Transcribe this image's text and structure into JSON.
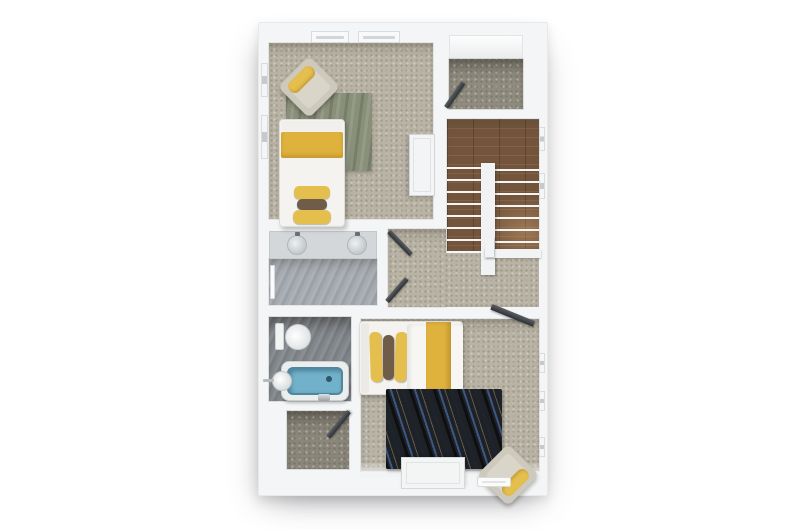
{
  "scene": {
    "type": "3d-floor-plan-render",
    "view": "top-down dollhouse",
    "background": "#ffffff",
    "floor_label": "upper floor"
  },
  "colors": {
    "wall": "#f4f5f6",
    "carpet": "#b8b3a4",
    "carpet_dark": "#8f8c7f",
    "carpet_dark2": "#8a867a",
    "wood": "#74553b",
    "tile_light": "#a6abb1",
    "tile_dark": "#82878c",
    "vanity": "#d3d7da",
    "rug_green": "#89907a",
    "rug_dark": "#1e2126",
    "accent_yellow": "#e5bf4e",
    "accent_yellow_deep": "#dfb23e",
    "pillow_brown": "#6f5c49",
    "tub_blue": "#72b1ca",
    "chair_beige": "#cdc9bc",
    "door_dark": "#3a3f44",
    "furniture_white": "#f3f4f4"
  },
  "rooms": [
    {
      "id": "bedroom-2",
      "name": "Bedroom 2 (single)"
    },
    {
      "id": "store",
      "name": "Store cupboard"
    },
    {
      "id": "stairwell",
      "name": "Staircase"
    },
    {
      "id": "landing",
      "name": "Landing / hallway"
    },
    {
      "id": "ensuite",
      "name": "Shower room with twin sinks"
    },
    {
      "id": "bathroom",
      "name": "Bathroom with bathtub"
    },
    {
      "id": "cupboard",
      "name": "Airing cupboard"
    },
    {
      "id": "bedroom-1",
      "name": "Bedroom 1 (double)"
    }
  ],
  "furniture": {
    "bed_single": "single bed with yellow runner and pillows",
    "bed_double": "double bed with yellow runner and pillows",
    "armchair_1": "beige armchair with yellow bolster",
    "armchair_2": "beige armchair with yellow bolster",
    "wardrobe": "white wardrobe",
    "dresser": "white chest of drawers",
    "rug_green": "sage green rug",
    "rug_dark": "dark abstract rug",
    "bathtub": "blue bathtub",
    "toilet": "toilet",
    "basin": "wall basin",
    "sinks": "twin vanity sinks",
    "stairs": "U-shaped staircase with white treads",
    "doors_open": "5 open dark door leaves"
  }
}
